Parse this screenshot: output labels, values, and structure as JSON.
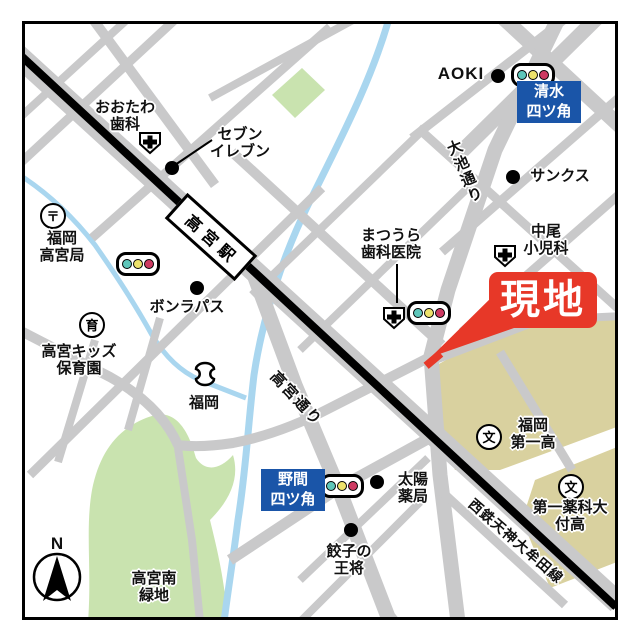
{
  "site_marker": {
    "label": "現地"
  },
  "station": {
    "name": "高宮駅"
  },
  "streets": {
    "oike": "大池通り",
    "takamiya": "高宮通り",
    "nishitetsu": "西鉄天神大牟田線"
  },
  "crossings": {
    "shimizu": {
      "line1": "清水",
      "line2": "四ツ角"
    },
    "noma": {
      "line1": "野間",
      "line2": "四ツ角"
    }
  },
  "landmarks": {
    "otawa_dental": {
      "line1": "おおたわ",
      "line2": "歯科"
    },
    "seven_eleven": {
      "line1": "セブン",
      "line2": "イレブン"
    },
    "post_office": {
      "line1": "福岡",
      "line2": "高宮局"
    },
    "bonrepas": {
      "name": "ボンラパス"
    },
    "kids_nursery": {
      "line1": "高宮キッズ",
      "line2": "保育園"
    },
    "fukuoka_bank": {
      "name": "福岡"
    },
    "takamiya_minami_park": {
      "line1": "高宮南",
      "line2": "緑地"
    },
    "aoki": {
      "name": "AOKI"
    },
    "sunkus": {
      "name": "サンクス"
    },
    "nakao_pediatrics": {
      "line1": "中尾",
      "line2": "小児科"
    },
    "matsuura_dental": {
      "line1": "まつうら",
      "line2": "歯科医院"
    },
    "taiyo_pharmacy": {
      "line1": "太陽",
      "line2": "薬局"
    },
    "gyoza_ohsho": {
      "line1": "餃子の",
      "line2": "王将"
    },
    "fukuoka_daiichi_high": {
      "line1": "福岡",
      "line2": "第一高"
    },
    "daiichi_yakka_high": {
      "line1": "第一薬科大",
      "line2": "付高"
    }
  },
  "icons": {
    "post_office_glyph": "〒",
    "nursery_glyph": "育",
    "school_glyph": "文"
  },
  "compass": {
    "north": "N"
  },
  "colors": {
    "road_gray": "#C9C9CA",
    "railway_black": "#000000",
    "river_blue": "#A9D6EF",
    "park_green": "#C9E3AF",
    "school_ground_khaki": "#D9D19F",
    "crossing_box_blue": "#1A55A8",
    "site_red": "#E73828",
    "signal_teal": "#5EC6BA",
    "signal_yellow": "#EDE26B",
    "signal_red": "#CE3A62"
  }
}
